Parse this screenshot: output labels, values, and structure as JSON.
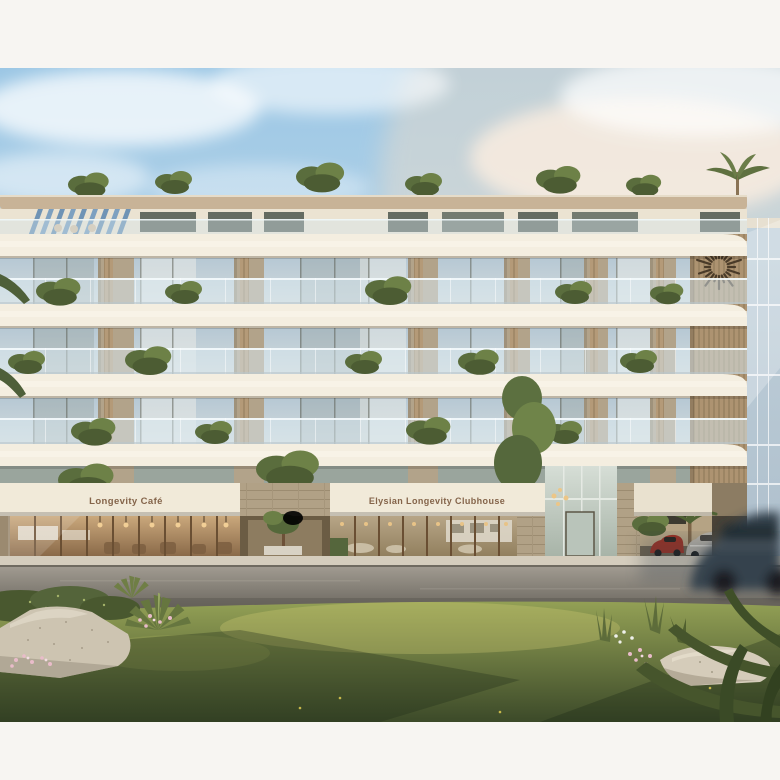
{
  "scene": {
    "type": "architectural-exterior-rendering",
    "subject": "Mid-rise luxury residence with curved white balconies, rooftop garden, ground-floor cafe and clubhouse, street and lawn in foreground"
  },
  "signs": {
    "cafe": "Longevity Café",
    "clubhouse": "Elysian Longevity Clubhouse"
  },
  "icons": {
    "sunburst_logo": "sunburst-emblem-on-wood-slats"
  },
  "palette": {
    "margin_white": "#f7f5f2",
    "sky_blue": "#a9cfe8",
    "cloud_warm": "#f0ddc8",
    "facade_cream": "#f3edde",
    "roof_wood": "#c8b397",
    "stone_pier": "#b2a38a",
    "glass_blue": "#b6c8d4",
    "wood_slats": "#b49a78",
    "sign_bronze": "#84644a",
    "street_gray": "#8a857c",
    "sidewalk": "#d5cdbd",
    "grass_green": "#5d6f3b",
    "boulder": "#cdc4b1",
    "flower_pink": "#e9bcca",
    "red_car": "#9c3023",
    "silver_car": "#b6b1a8",
    "passing_car": "#35424d",
    "pergola_blue": "#6f93b5"
  }
}
